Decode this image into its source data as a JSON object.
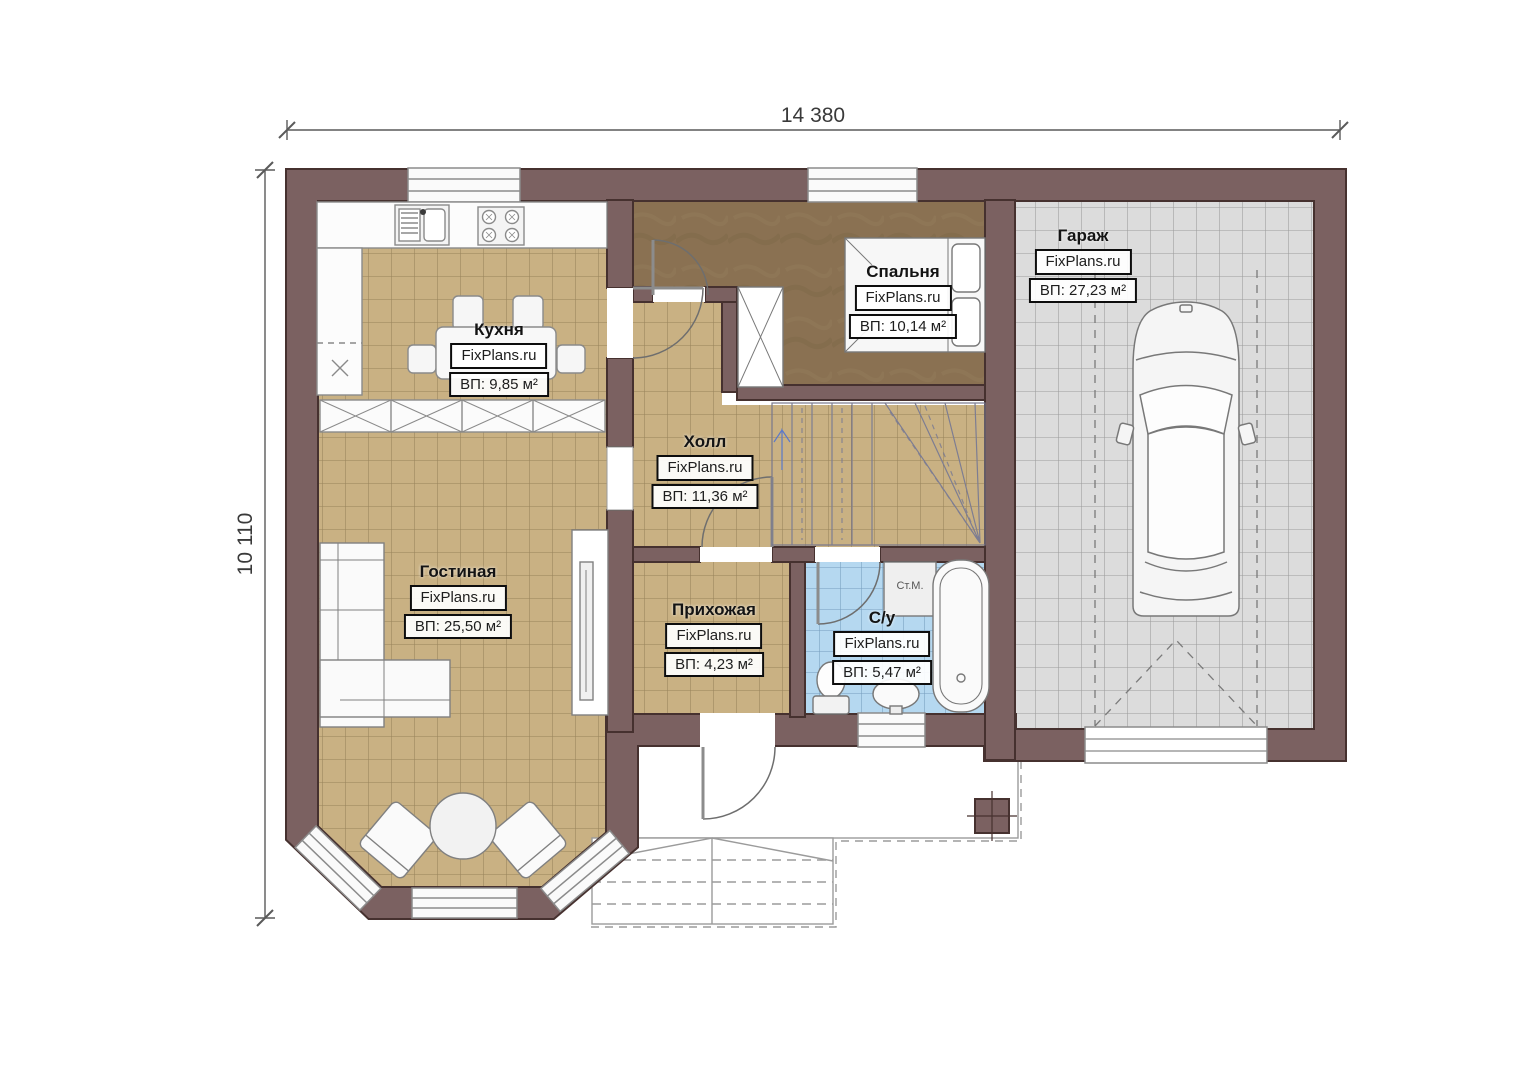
{
  "title": "Floor plan (first floor)",
  "dimensions": {
    "width_label": "14 380",
    "height_label": "10 110"
  },
  "branding": {
    "watermark": "FixPlans.ru"
  },
  "rooms": [
    {
      "id": "kitchen",
      "name": "Кухня",
      "area": "ВП: 9,85 м²"
    },
    {
      "id": "bedroom",
      "name": "Спальня",
      "area": "ВП: 10,14 м²"
    },
    {
      "id": "garage",
      "name": "Гараж",
      "area": "ВП: 27,23 м²"
    },
    {
      "id": "hall",
      "name": "Холл",
      "area": "ВП: 11,36 м²"
    },
    {
      "id": "living",
      "name": "Гостиная",
      "area": "ВП: 25,50 м²"
    },
    {
      "id": "entry",
      "name": "Прихожая",
      "area": "ВП: 4,23 м²"
    },
    {
      "id": "bathroom",
      "name": "С/у",
      "area": "ВП: 5,47 м²"
    }
  ],
  "annotations": {
    "washing_machine": "Ст.М."
  },
  "palette": {
    "wall": "#7b6161",
    "wall_outline": "#46312f",
    "floor_tile_tan": "#c9b183",
    "floor_bedroom": "#8a7152",
    "floor_bath_blue": "#b5d8f0",
    "floor_garage_gray": "#dcdcdc",
    "fixture_stroke": "#787878",
    "label_border": "#0d0d0d"
  }
}
